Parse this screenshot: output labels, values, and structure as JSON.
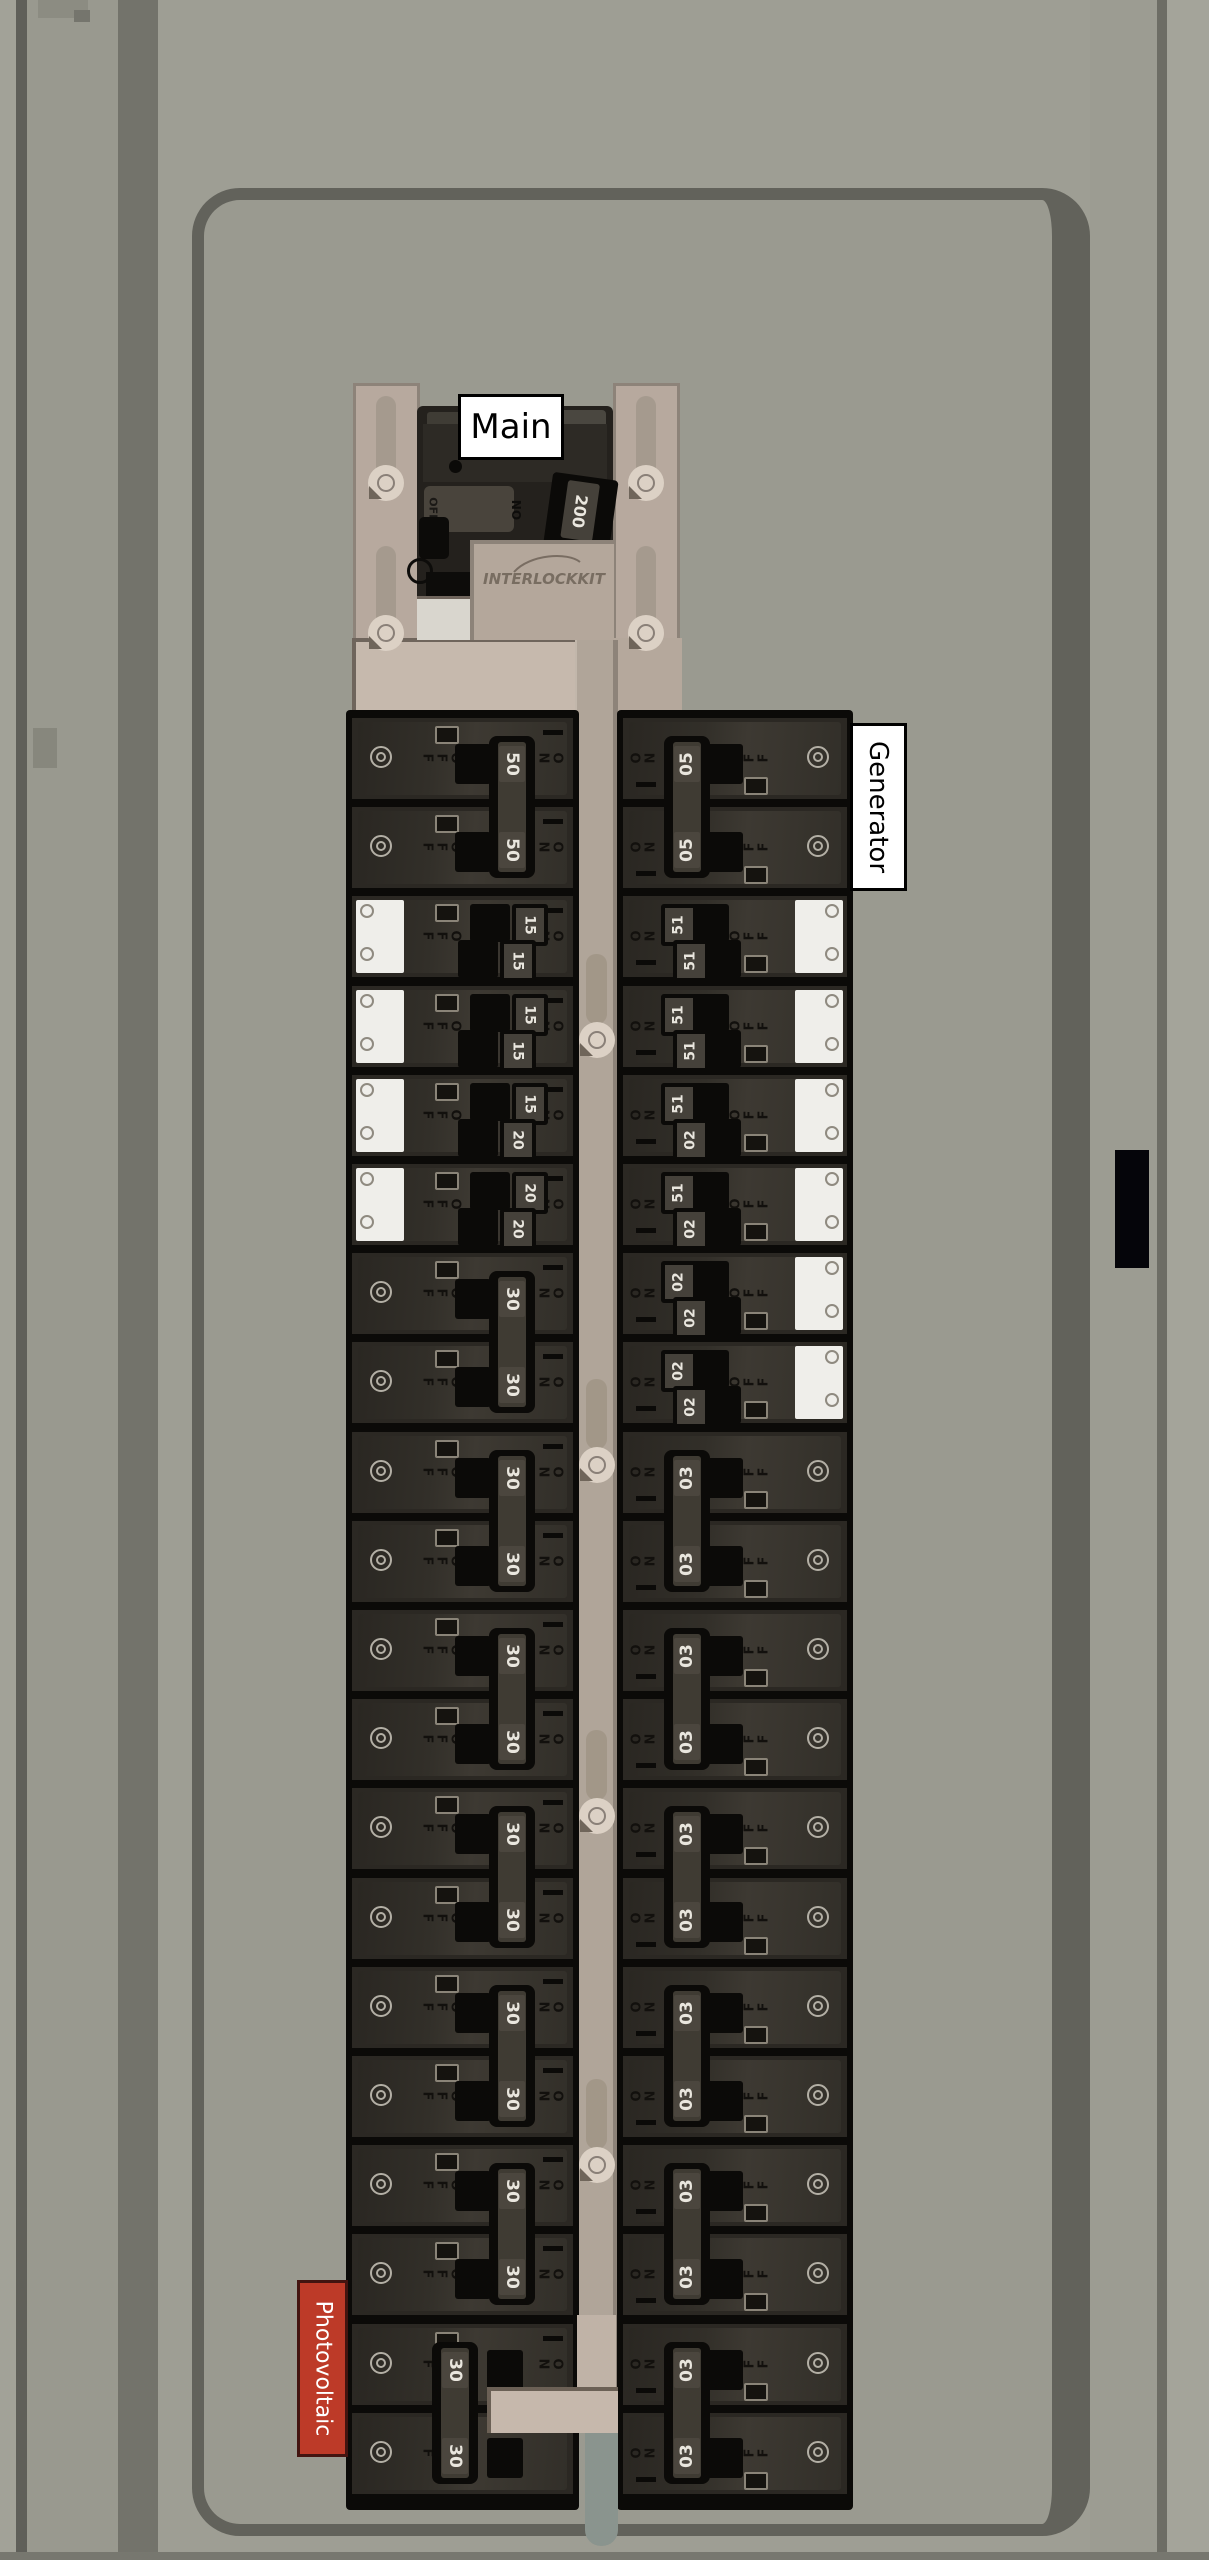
{
  "labels": {
    "main": "Main",
    "main_amps": "200",
    "generator": "Generator",
    "photovoltaic": "Photovoltaic",
    "interlock_logo": "INTERLOCKKIT",
    "on": "ON",
    "off": "OFF"
  },
  "colors": {
    "panel_gray": "#9e9e94",
    "interior_gray": "#9a9a90",
    "door_line": "#62625b",
    "breaker_body": "#2b2823",
    "interlock_tan": "#b7a99e",
    "slide_tan": "#c6b9ad",
    "photovoltaic_red": "#bd3a28",
    "label_white": "#ffffff"
  },
  "panel": {
    "main_breaker": {
      "label": "Main",
      "amps": "200",
      "state": "on"
    },
    "left_column": {
      "units": [
        {
          "type": "2-pole",
          "amps": [
            "50",
            "50"
          ],
          "start_row": 0
        },
        {
          "type": "tandem",
          "amps": [
            "15",
            "15"
          ],
          "start_row": 2,
          "sticker": true
        },
        {
          "type": "tandem",
          "amps": [
            "15",
            "15"
          ],
          "start_row": 3,
          "sticker": true
        },
        {
          "type": "tandem",
          "amps": [
            "15",
            "20"
          ],
          "start_row": 4,
          "sticker": true
        },
        {
          "type": "tandem",
          "amps": [
            "20",
            "20"
          ],
          "start_row": 5,
          "sticker": true
        },
        {
          "type": "2-pole",
          "amps": [
            "30",
            "30"
          ],
          "start_row": 6
        },
        {
          "type": "2-pole",
          "amps": [
            "30",
            "30"
          ],
          "start_row": 8
        },
        {
          "type": "2-pole",
          "amps": [
            "30",
            "30"
          ],
          "start_row": 10
        },
        {
          "type": "2-pole",
          "amps": [
            "30",
            "30"
          ],
          "start_row": 12
        },
        {
          "type": "2-pole",
          "amps": [
            "30",
            "30"
          ],
          "start_row": 14
        },
        {
          "type": "2-pole",
          "amps": [
            "30",
            "30"
          ],
          "start_row": 16
        },
        {
          "type": "2-pole",
          "amps": [
            "30",
            "30"
          ],
          "start_row": 18,
          "state": "off",
          "circuit": "photovoltaic"
        }
      ]
    },
    "right_column": {
      "units": [
        {
          "type": "2-pole",
          "amps": [
            "50",
            "50"
          ],
          "start_row": 0,
          "circuit": "generator"
        },
        {
          "type": "tandem",
          "amps": [
            "15",
            "15"
          ],
          "start_row": 2,
          "sticker": true
        },
        {
          "type": "tandem",
          "amps": [
            "15",
            "15"
          ],
          "start_row": 3,
          "sticker": true
        },
        {
          "type": "tandem",
          "amps": [
            "15",
            "20"
          ],
          "start_row": 4,
          "sticker": true
        },
        {
          "type": "tandem",
          "amps": [
            "15",
            "20"
          ],
          "start_row": 5,
          "sticker": true
        },
        {
          "type": "tandem",
          "amps": [
            "20",
            "20"
          ],
          "start_row": 6,
          "sticker": true
        },
        {
          "type": "tandem",
          "amps": [
            "20",
            "20"
          ],
          "start_row": 7,
          "sticker": true
        },
        {
          "type": "2-pole",
          "amps": [
            "30",
            "30"
          ],
          "start_row": 8
        },
        {
          "type": "2-pole",
          "amps": [
            "30",
            "30"
          ],
          "start_row": 10
        },
        {
          "type": "2-pole",
          "amps": [
            "30",
            "30"
          ],
          "start_row": 12
        },
        {
          "type": "2-pole",
          "amps": [
            "30",
            "30"
          ],
          "start_row": 14
        },
        {
          "type": "2-pole",
          "amps": [
            "30",
            "30"
          ],
          "start_row": 16
        },
        {
          "type": "2-pole",
          "amps": [
            "30",
            "30"
          ],
          "start_row": 18
        }
      ]
    }
  }
}
